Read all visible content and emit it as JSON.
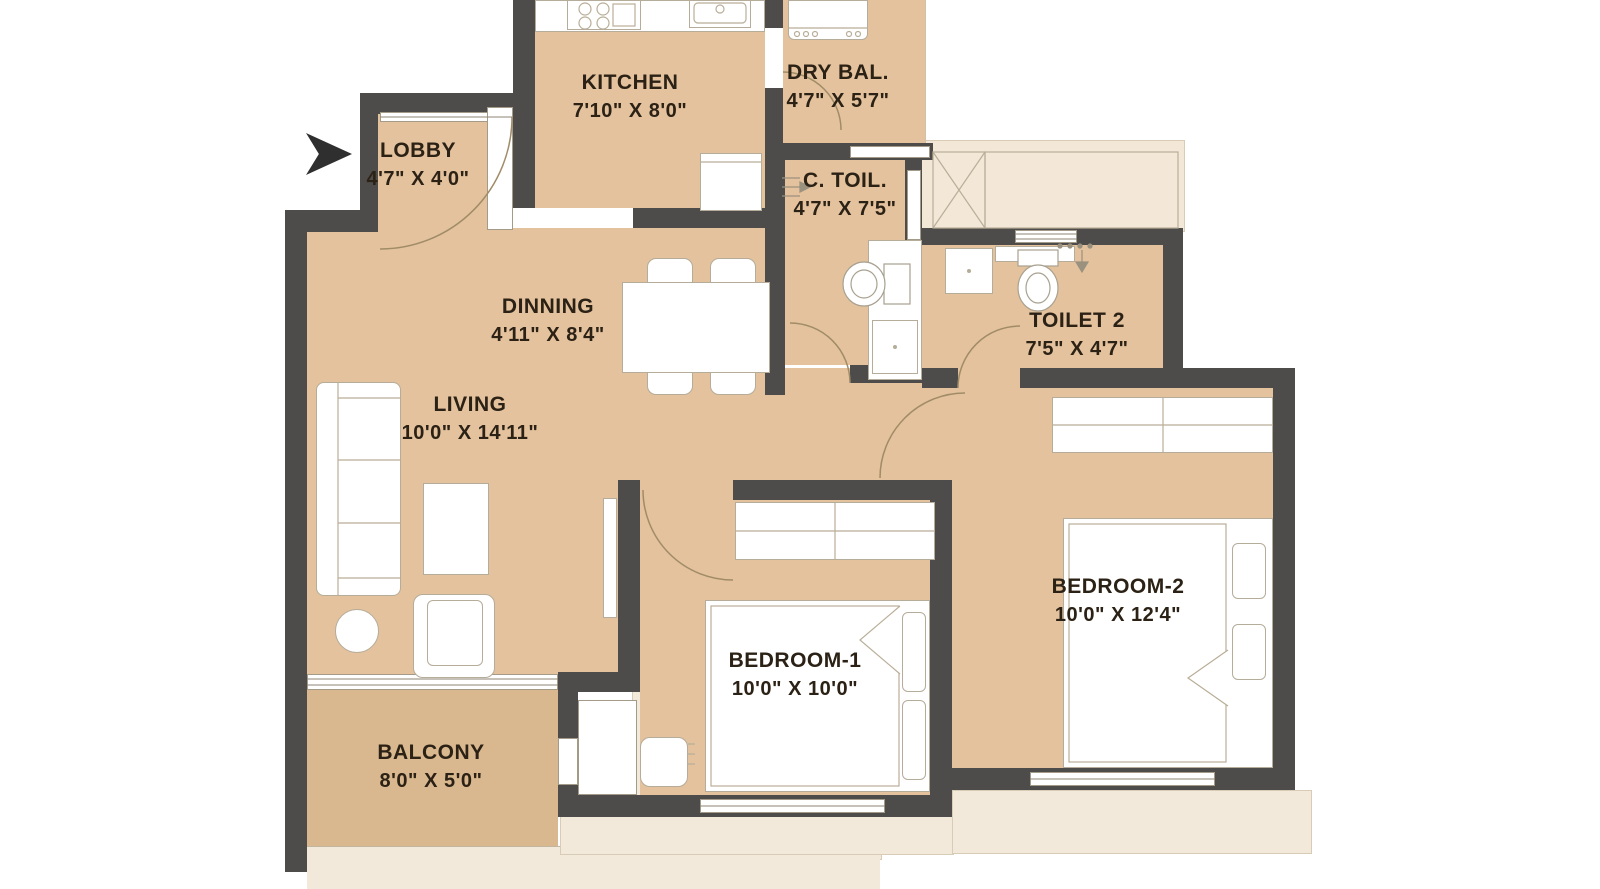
{
  "rooms": [
    {
      "name": "KITCHEN",
      "dims": "7'10\" X 8'0\""
    },
    {
      "name": "DRY BAL.",
      "dims": "4'7\" X 5'7\""
    },
    {
      "name": "LOBBY",
      "dims": "4'7\" X 4'0\""
    },
    {
      "name": "C. TOIL.",
      "dims": "4'7\" X 7'5\""
    },
    {
      "name": "DINNING",
      "dims": "4'11\" X 8'4\""
    },
    {
      "name": "TOILET 2",
      "dims": "7'5\" X 4'7\""
    },
    {
      "name": "LIVING",
      "dims": "10'0\" X 14'11\""
    },
    {
      "name": "BEDROOM-1",
      "dims": "10'0\" X 10'0\""
    },
    {
      "name": "BEDROOM-2",
      "dims": "10'0\" X 12'4\""
    },
    {
      "name": "BALCONY",
      "dims": "8'0\" X 5'0\""
    }
  ],
  "icons": {
    "entry_marker": "entry-arrow"
  },
  "colors": {
    "wall": "#4d4c4a",
    "floor": "#e3c29d",
    "balcony_floor": "#d9b88f",
    "deck": "#f2e9db",
    "label_text": "#2b2115"
  }
}
